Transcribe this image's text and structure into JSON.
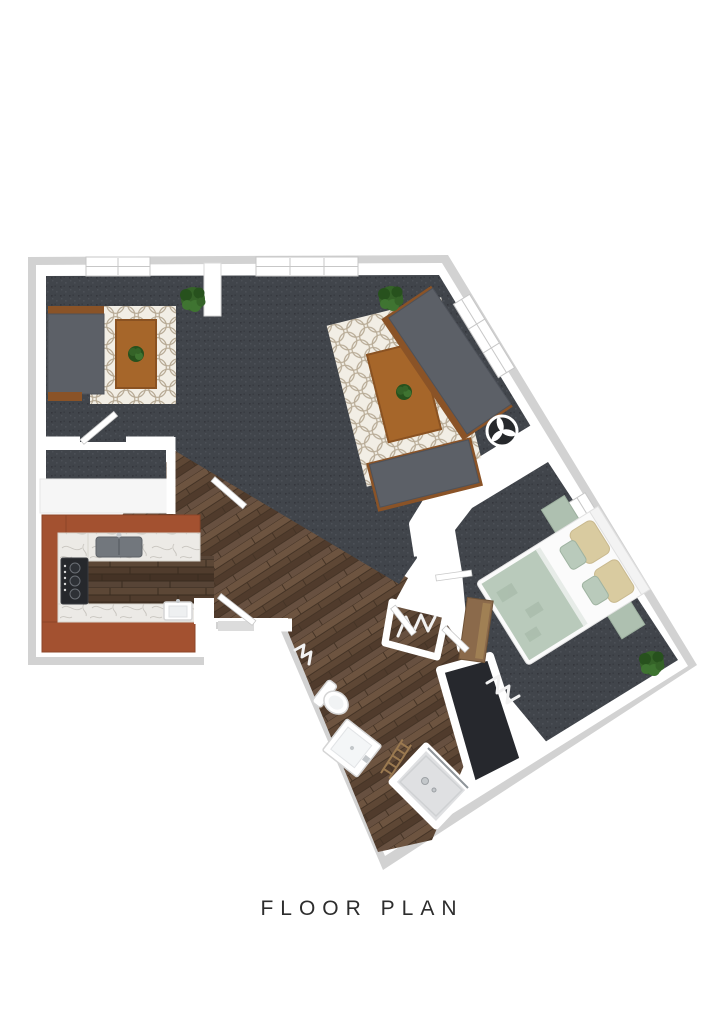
{
  "title": {
    "text": "FLOOR PLAN"
  },
  "palette": {
    "bg": "#ffffff",
    "text": "#2d2d2d",
    "wall_outer": "#d2d2d2",
    "wall_inner": "#ffffff",
    "carpet": "#41454b",
    "carpet_dot_light": "#4c5057",
    "carpet_dot_dark": "#34373d",
    "carpet_dark": "#26282d",
    "wood_base": "#5e4735",
    "wood_mid": "#675040",
    "wood_deep": "#503b2c",
    "wood_light": "#6d5440",
    "wood_dark": "#453426",
    "cabinet": "#a35130",
    "cabinet_dark": "#8c4527",
    "marble": "#eceae6",
    "marble_vein": "#c9c6c0",
    "rug_base": "#f2eee5",
    "rug_line": "#b7aa95",
    "sofa": "#5c6067",
    "sofa_dark": "#4e525a",
    "trim_wood": "#8a5327",
    "table_wood": "#a6662a",
    "table_wood_dark": "#8a5222",
    "plant": "#356328",
    "plant_dark": "#27511d",
    "plant_light": "#3f7431",
    "duvet": "#b9cabb",
    "duvet_dark": "#9fb3a1",
    "pillow": "#d9cba0",
    "bed_frame": "#fbfbfb",
    "nightstand": "#aec0b0",
    "shower": "#dfe0e2",
    "chrome": "#c3c7ca",
    "stove": "#26282c",
    "sink_basin": "#72777d",
    "black_table": "#26282b",
    "door": "#ffffff",
    "door_edge": "#c9c9c9",
    "fixture_stroke": "#d5d5d5"
  },
  "depicted_objects": [
    "living-area",
    "open-lounge",
    "bedroom",
    "kitchen",
    "bathroom",
    "walk-in-closet",
    "coat-closet",
    "entry",
    "den-closet",
    "sofa",
    "bench-seat",
    "coffee-table",
    "side-round-table",
    "area-rug",
    "bed",
    "nightstand",
    "dresser",
    "toilet",
    "vanity-sink",
    "shower",
    "towel-ladder",
    "cooktop-stove",
    "kitchen-sink",
    "prep-sink",
    "potted-plant",
    "window",
    "door"
  ]
}
